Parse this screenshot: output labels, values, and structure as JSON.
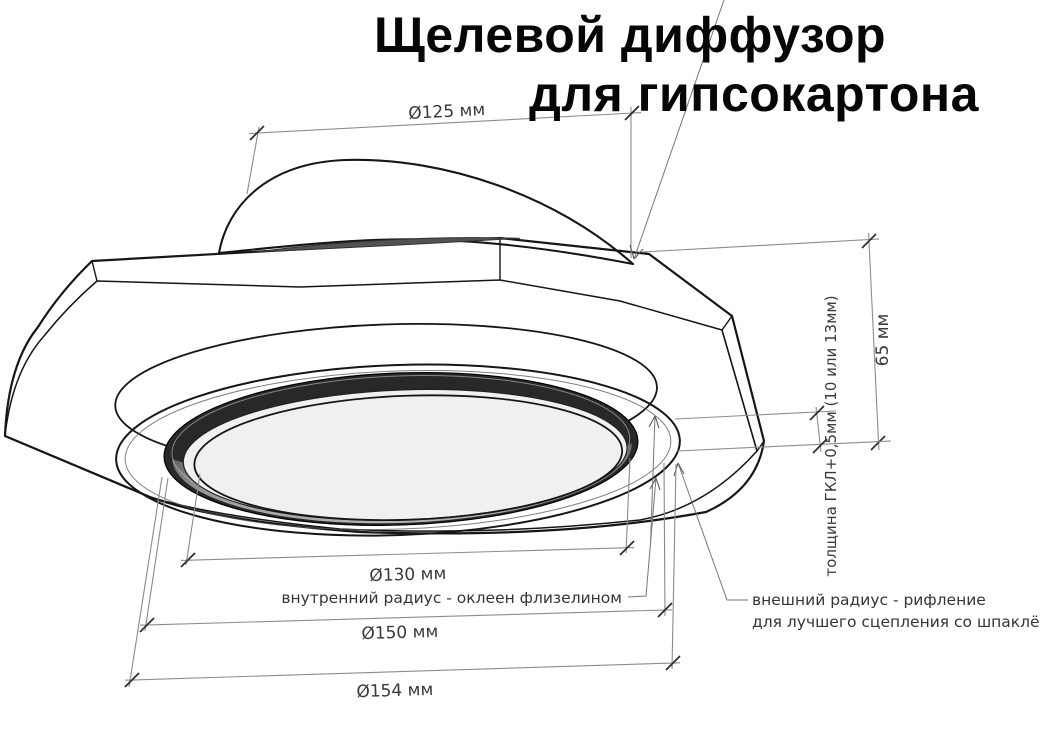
{
  "title": {
    "line1": "Щелевой диффузор",
    "line2": "для гипсокартона"
  },
  "dimensions": {
    "duct_diameter": "Ø125 мм",
    "slot_inner_diameter": "Ø130 мм",
    "rim_diameter": "Ø150 мм",
    "flange_outer_diameter": "Ø154 мм",
    "height": "65 мм",
    "drywall_thickness": "толщина ГКЛ+0,5мм (10 или 13мм)"
  },
  "notes": {
    "inner_radius": "внутренний радиус - оклеен флизелином",
    "outer_radius_line1": "внешний радиус - рифление",
    "outer_radius_line2": "для лучшего сцепления со шпаклёвкой"
  },
  "colors": {
    "background": "#ffffff",
    "outline": "#161616",
    "plate_face": "#b6b6b6",
    "plate_side_facet": "#9c9c9c",
    "slot_dark": "#282828",
    "dimension_line": "#8d8d8d",
    "text": "#3a3a3a"
  }
}
